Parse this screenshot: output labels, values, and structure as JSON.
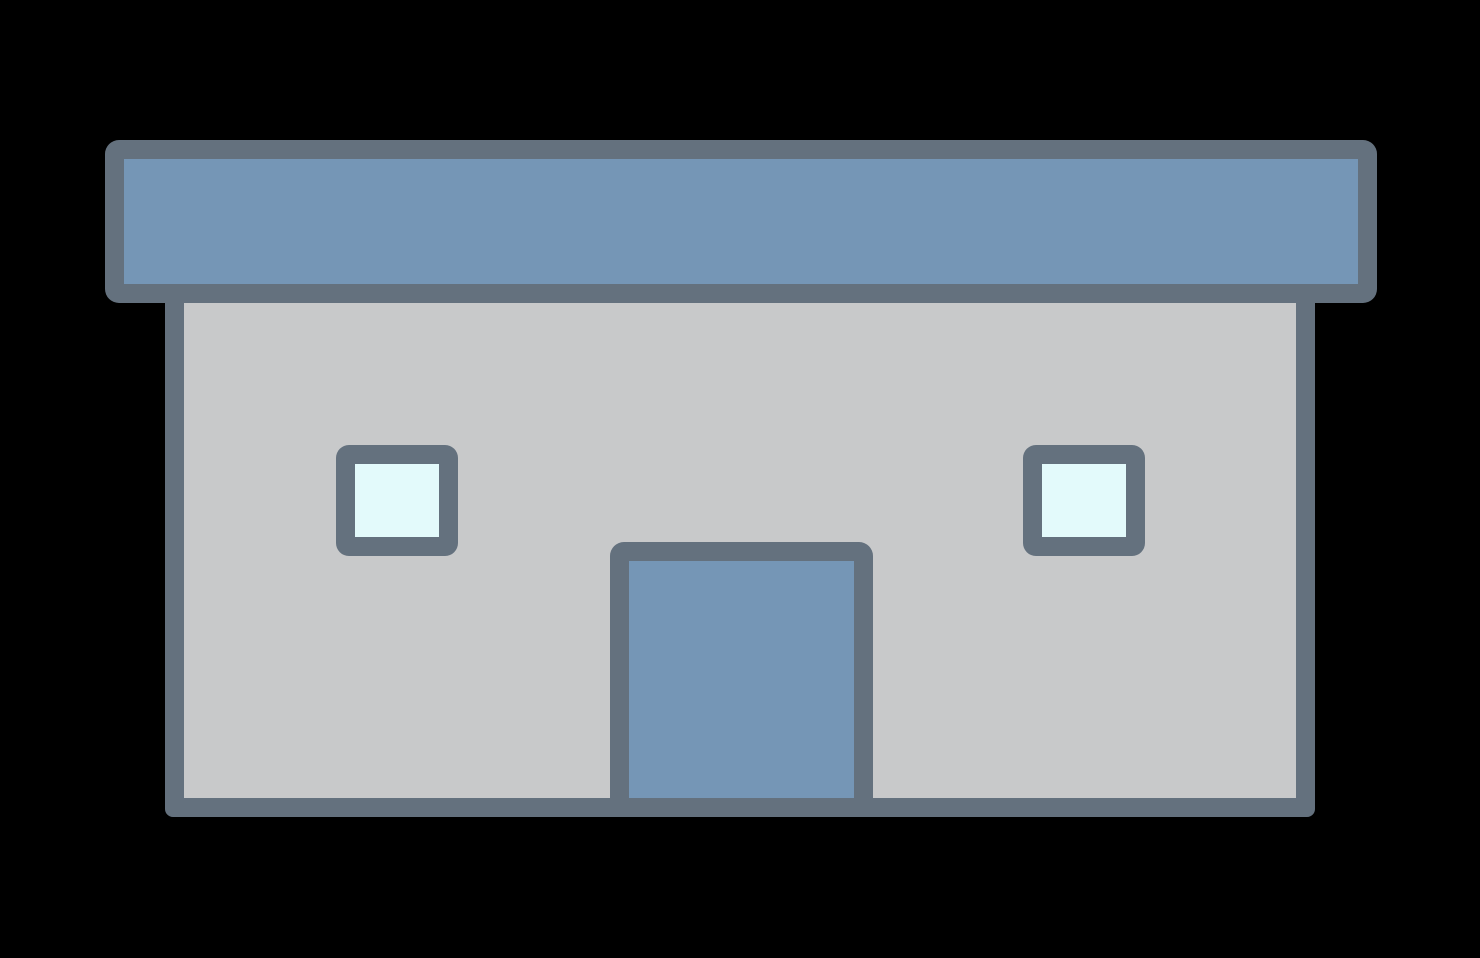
{
  "image": {
    "description": "Flat clipart-style icon of a single-story building: a wide overhanging flat blue roof with slate outline, a light gray facade, two small pale-cyan windows, and a centered blue door reaching the base, all on a black background",
    "text_content": "none"
  },
  "colors": {
    "background": "#000000",
    "outline": "#64717E",
    "roof-fill": "#7596B6",
    "wall-fill": "#C8C9CA",
    "window-fill": "#E3FAFB",
    "door-fill": "#7596B6"
  },
  "building": {
    "parts": [
      "roof",
      "facade",
      "window-left",
      "window-right",
      "door"
    ],
    "window_count": 2,
    "door_count": 1,
    "stories": 1
  }
}
